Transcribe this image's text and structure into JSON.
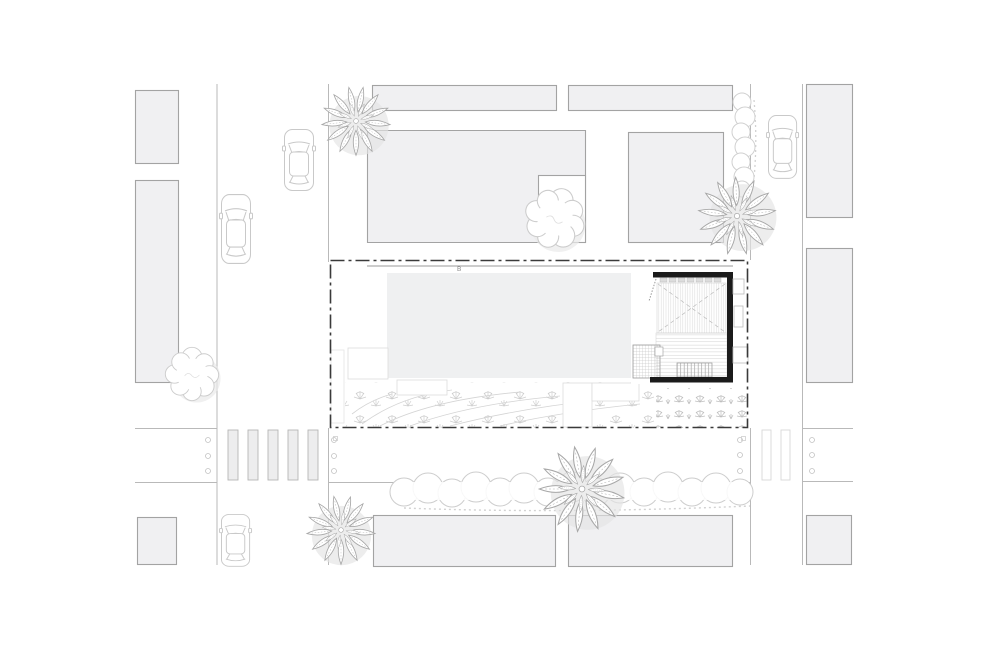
{
  "plan": {
    "marker_label": "B",
    "colors": {
      "background": "#ffffff",
      "building_fill": "#f0f0f2",
      "building_stroke": "#a3a3a3",
      "slab_fill": "#eff0f1",
      "wall_black": "#1b1b1b",
      "boundary": "#3a3a3a",
      "curb": "#b9b9b9",
      "car_stroke": "#c9c9c9",
      "tree_stroke": "#a8a8a8",
      "cloud_stroke": "#cccccc",
      "vegetation": "#c6c6c6"
    }
  }
}
